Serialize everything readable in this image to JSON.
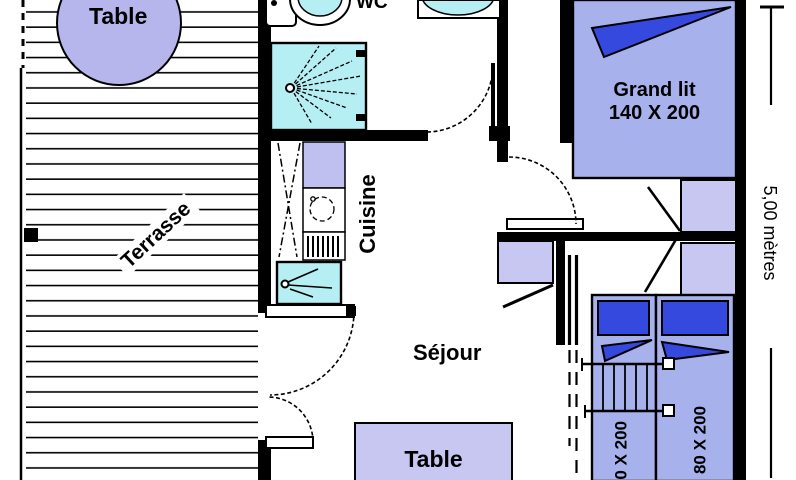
{
  "labels": {
    "terrace": "Terrasse",
    "terrace_table": "Table",
    "wc": "WC",
    "kitchen": "Cuisine",
    "living_room": "Séjour",
    "dining_table": "Table",
    "double_bed_name": "Grand lit",
    "double_bed_size": "140 X 200",
    "single_bed_left_size": "80 X 200",
    "single_bed_right_size": "80 X 200",
    "dimension_right": "5,00 mètres"
  },
  "colors": {
    "wall": "#000000",
    "bed_fill": "#a7b2ec",
    "pillow_blue": "#3549df",
    "furniture_lavender": "#c7c7f2",
    "round_table_lavender": "#b6b6ec",
    "sanitary_cyan": "#b6eff3",
    "background": "#ffffff"
  }
}
